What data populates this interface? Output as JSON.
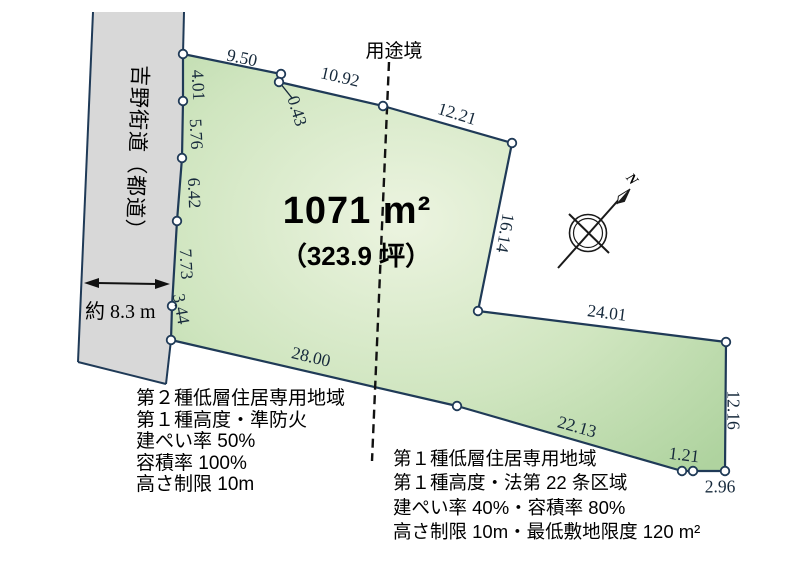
{
  "colors": {
    "plot_fill_light": "#ecf4e0",
    "plot_fill_dark": "#afd39f",
    "plot_border": "#1f3a57",
    "road_fill": "#d8d8d8",
    "dim_text": "#16293b",
    "ink": "#000000"
  },
  "road": {
    "name": "吉野街道（都道）",
    "width_label": "約 8.3 m"
  },
  "boundary": {
    "label": "用途境"
  },
  "compass": {
    "label": "N"
  },
  "area": {
    "sqm": "1071 m²",
    "tsubo": "（323.9 坪）"
  },
  "dims": {
    "top1": "9.50",
    "jog": "0.43",
    "top2": "10.92",
    "top3": "12.21",
    "right_upper": "16.14",
    "notch_top": "24.01",
    "right_lower": "12.16",
    "corner_jog": "1.21",
    "corner_bottom": "2.96",
    "bottom_right": "22.13",
    "bottom_left": "28.00",
    "left1": "4.01",
    "left2": "5.76",
    "left3": "6.42",
    "left4": "7.73",
    "left5": "3.44"
  },
  "zoning_left": {
    "lines": [
      "第２種低層住居専用地域",
      "第１種高度・準防火",
      "建ぺい率 50%",
      "容積率 100%",
      "高さ制限 10m"
    ]
  },
  "zoning_right": {
    "lines": [
      "第１種低層住居専用地域",
      "第１種高度・法第 22 条区域",
      "建ぺい率 40%・容積率 80%",
      "高さ制限 10m・最低敷地限度 120 m²"
    ]
  }
}
